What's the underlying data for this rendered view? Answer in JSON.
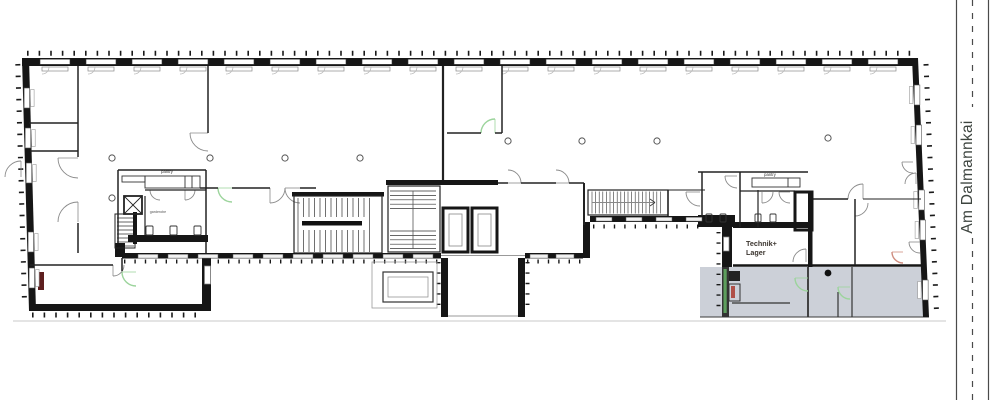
{
  "labels": {
    "pantry_left": "pantry",
    "pantry_right": "pantry",
    "cloakroom": "garderobe",
    "technik_line1": "Technik+",
    "technik_line2": "Lager",
    "street": "Am Dalmannkai"
  },
  "colors": {
    "wall": "#161616",
    "terrace_fill": "#ccd0d8",
    "door_green": "#9cd49c",
    "door_salmon": "#cf8d7f",
    "accent_dark_red": "#5e1f1f",
    "accent_red_mark": "#b05048",
    "hedge_green": "#5d9e5d",
    "street_text": "#3d443f",
    "site_line": "#c9c9c9"
  }
}
